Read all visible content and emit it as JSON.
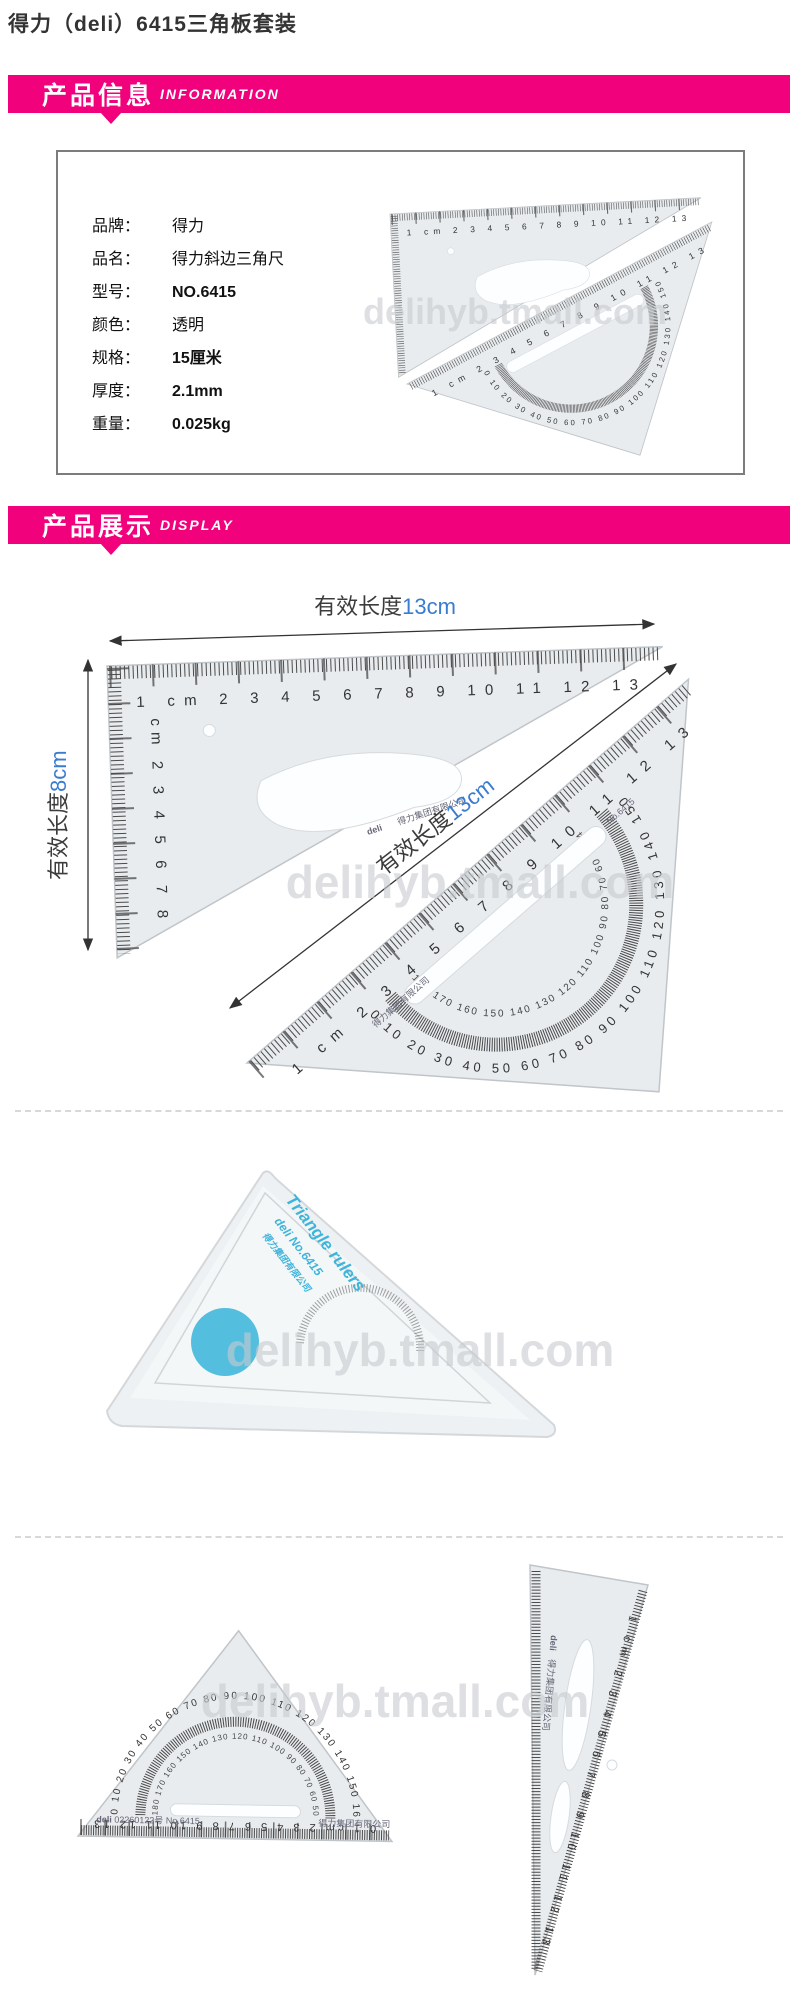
{
  "page_title": "得力（deli）6415三角板套装",
  "banners": {
    "info": {
      "title": "产品信息",
      "subtitle": "INFORMATION"
    },
    "display": {
      "title": "产品展示",
      "subtitle": "DISPLAY"
    }
  },
  "specs": [
    {
      "label": "品牌：",
      "value": "得力"
    },
    {
      "label": "品名：",
      "value": "得力斜边三角尺"
    },
    {
      "label": "型号：",
      "value": "NO.6415"
    },
    {
      "label": "颜色：",
      "value": "透明"
    },
    {
      "label": "规格：",
      "value": "15厘米"
    },
    {
      "label": "厚度：",
      "value": "2.1mm"
    },
    {
      "label": "重量：",
      "value": "0.025kg"
    }
  ],
  "watermark": "delihyb.tmall.com",
  "annotations": {
    "top": {
      "label": "有效长度",
      "value": "13cm"
    },
    "left": {
      "label": "有效长度",
      "value": "8cm"
    },
    "diagonal": {
      "label": "有效长度",
      "value": "13cm"
    }
  },
  "ruler_print": {
    "scale_cm": "1 cm 2 3 4 5 6 7 8 9 10 11 12 13",
    "scale_cm_with_zero": "0 1 cm 2 3 4 5 6 7 8 9 10 11 12 13",
    "scale_cm_vertical": "cm 2 3 4 5 6 7 8",
    "protractor_outer": "0 10 20 30 40 50 60 70 80 90 100 110 120 130 140 150 160 170 180",
    "protractor_inner": "180 170 160 150 140 130 120 110 100 90 80 70 60 50 40 30 20 10 0",
    "brand": "deli",
    "company": "得力集团有限公司",
    "model": "No.6415",
    "print_code": "02260122号 No.6415",
    "package_print": "Triangle rulers"
  },
  "colors": {
    "banner_pink": "#f1017c",
    "dimension_blue": "#3a7cd0",
    "sticker_blue": "#45b9dc",
    "ruler_gray": "#e9ecef"
  }
}
